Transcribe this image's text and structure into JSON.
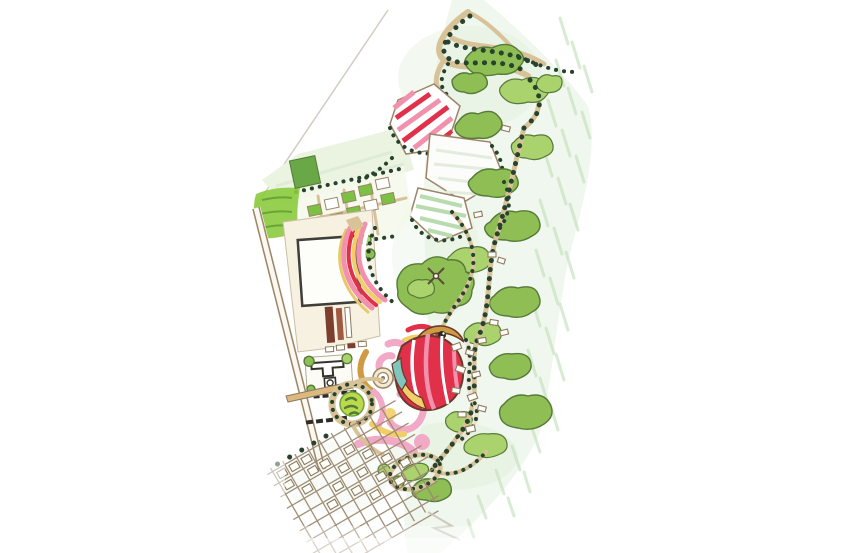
{
  "meta": {
    "title": "Hand-drawn landscape master plan",
    "description": "Watercolor-and-ink site plan sketch of a park / garden festival grounds with woodland trails, striped flower fields, a central flower dome sculpture, campus buildings and a village street grid, on white paper with a light green wash."
  },
  "canvas": {
    "width": 856,
    "height": 553,
    "background": "#ffffff"
  },
  "palette": {
    "paper": "#ffffff",
    "wash": "#dcecd6",
    "hatch": "#c3e0bb",
    "pencil": "#c9c3b8",
    "path_tan": "#d8c298",
    "path_edge": "#9b8566",
    "sepia": "#8d7a5e",
    "grid_sepia": "#9b8970",
    "tree_dot": "#27422d",
    "foliage": "#8fbe55",
    "foliage_light": "#abd36d",
    "foliage_dark": "#567a38",
    "plot_green": "#7cc143",
    "scribble_green": "#8ccb3e",
    "field_pale": "#ebf4e1",
    "stripe_pink": "#f291ad",
    "stripe_red": "#e0304a",
    "stripe_yellow": "#f2ce66",
    "stripe_teal": "#7fc7bd",
    "swirl_pink": "#f2a9c6",
    "ochre": "#cf9a43",
    "terrace_brown": "#7c3f2f",
    "terrace_rust": "#a05a40",
    "building_white": "#fdfdfa",
    "court_ink": "#34332c"
  },
  "features": [
    {
      "name": "green-wash",
      "kind": "watercolor background band"
    },
    {
      "name": "boundary-pencil-line",
      "kind": "faint site boundary"
    },
    {
      "name": "woodland-trails",
      "kind": "tree-lined winding trails, north lobe"
    },
    {
      "name": "striped-flower-field",
      "kind": "pink/red striped planting field"
    },
    {
      "name": "event-lawn-field",
      "kind": "white pentagon lawn"
    },
    {
      "name": "striped-green-field",
      "kind": "green striped crop field"
    },
    {
      "name": "pale-meadow-field",
      "kind": "pale green meadow"
    },
    {
      "name": "orchard-plots",
      "kind": "grid of garden plots"
    },
    {
      "name": "scribble-grove",
      "kind": "bright green grove"
    },
    {
      "name": "shrub-masses",
      "kind": "watercolor tree masses"
    },
    {
      "name": "tree-allees",
      "kind": "paths lined with tree dots"
    },
    {
      "name": "rainbow-flower-road",
      "kind": "curving striped flower promenade"
    },
    {
      "name": "flower-dome-sculpture",
      "kind": "red striped dome with ochre crest"
    },
    {
      "name": "spiral-flower-gardens",
      "kind": "pink/yellow swirl beds"
    },
    {
      "name": "central-plaza",
      "kind": "concentric circular plaza"
    },
    {
      "name": "ring-garden",
      "kind": "circular garden with tree ring"
    },
    {
      "name": "campus",
      "kind": "main building, terraces, courtyard, service road"
    },
    {
      "name": "village-lanes",
      "kind": "small houses along winding lanes"
    },
    {
      "name": "village-grid",
      "kind": "dense sketched street grid, south"
    }
  ]
}
